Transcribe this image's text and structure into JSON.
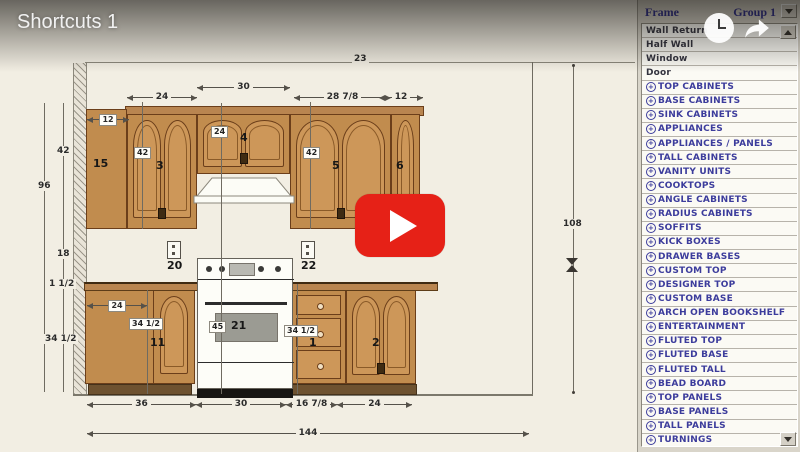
{
  "video": {
    "title": "Shortcuts 1",
    "icons": {
      "play": "play-icon",
      "watch_later": "clock-icon",
      "share": "share-arrow-icon"
    }
  },
  "colors": {
    "play_button_red": "#e62117",
    "sidebar_category_text": "#3c3c9c",
    "cabinet_wood": "#c18c4e",
    "canvas_cream": "#f2eee3"
  },
  "sidebar": {
    "header": {
      "frame": "Frame",
      "group": "Group 1"
    },
    "items": [
      {
        "label": "Wall Return"
      },
      {
        "label": "Half Wall"
      },
      {
        "label": "Window"
      },
      {
        "label": "Door"
      },
      {
        "label": "TOP CABINETS",
        "cat": true
      },
      {
        "label": "BASE CABINETS",
        "cat": true
      },
      {
        "label": "SINK CABINETS",
        "cat": true
      },
      {
        "label": "APPLIANCES",
        "cat": true
      },
      {
        "label": "APPLIANCES / PANELS",
        "cat": true
      },
      {
        "label": "TALL CABINETS",
        "cat": true
      },
      {
        "label": "VANITY UNITS",
        "cat": true
      },
      {
        "label": "COOKTOPS",
        "cat": true
      },
      {
        "label": "ANGLE CABINETS",
        "cat": true
      },
      {
        "label": "RADIUS CABINETS",
        "cat": true
      },
      {
        "label": "SOFFITS",
        "cat": true
      },
      {
        "label": "KICK BOXES",
        "cat": true
      },
      {
        "label": "DRAWER BASES",
        "cat": true
      },
      {
        "label": "CUSTOM TOP",
        "cat": true
      },
      {
        "label": "DESIGNER TOP",
        "cat": true
      },
      {
        "label": "CUSTOM BASE",
        "cat": true
      },
      {
        "label": "ARCH OPEN BOOKSHELF",
        "cat": true
      },
      {
        "label": "ENTERTAINMENT",
        "cat": true
      },
      {
        "label": "FLUTED TOP",
        "cat": true
      },
      {
        "label": "FLUTED BASE",
        "cat": true
      },
      {
        "label": "FLUTED TALL",
        "cat": true
      },
      {
        "label": "BEAD BOARD",
        "cat": true
      },
      {
        "label": "TOP PANELS",
        "cat": true
      },
      {
        "label": "BASE PANELS",
        "cat": true
      },
      {
        "label": "TALL PANELS",
        "cat": true
      },
      {
        "label": "TURNINGS",
        "cat": true
      }
    ]
  },
  "drawing": {
    "dims": {
      "room_width_top": "23",
      "upper_cab3_width": "24",
      "upper_cab4_width": "30",
      "upper_cab5_width": "28 7/8",
      "upper_cab6_width": "12",
      "wall_height": "96",
      "upper_height": "42",
      "backsplash_height": "18",
      "countertop_thickness": "1 1/2",
      "base_height": "34 1/2",
      "tall_depth": "12",
      "upper_box_left": "42",
      "cab4_height": "24",
      "upper_box_right": "42",
      "base_left_width": "24",
      "base_left_height": "34 1/2",
      "base_right_height": "34 1/2",
      "range_height": "45",
      "bottom_seg_a": "36",
      "bottom_seg_b": "30",
      "bottom_seg_c": "16 7/8",
      "bottom_seg_d": "24",
      "total_width": "144",
      "right_height": "108"
    },
    "items": {
      "tall_cabinet": "15",
      "cab3": "3",
      "cab4": "4",
      "cab5": "5",
      "cab6": "6",
      "base_cab11": "11",
      "drawer_base": "1",
      "base_cab2": "2",
      "outlet_left": "20",
      "outlet_right": "22",
      "range": "21"
    }
  }
}
